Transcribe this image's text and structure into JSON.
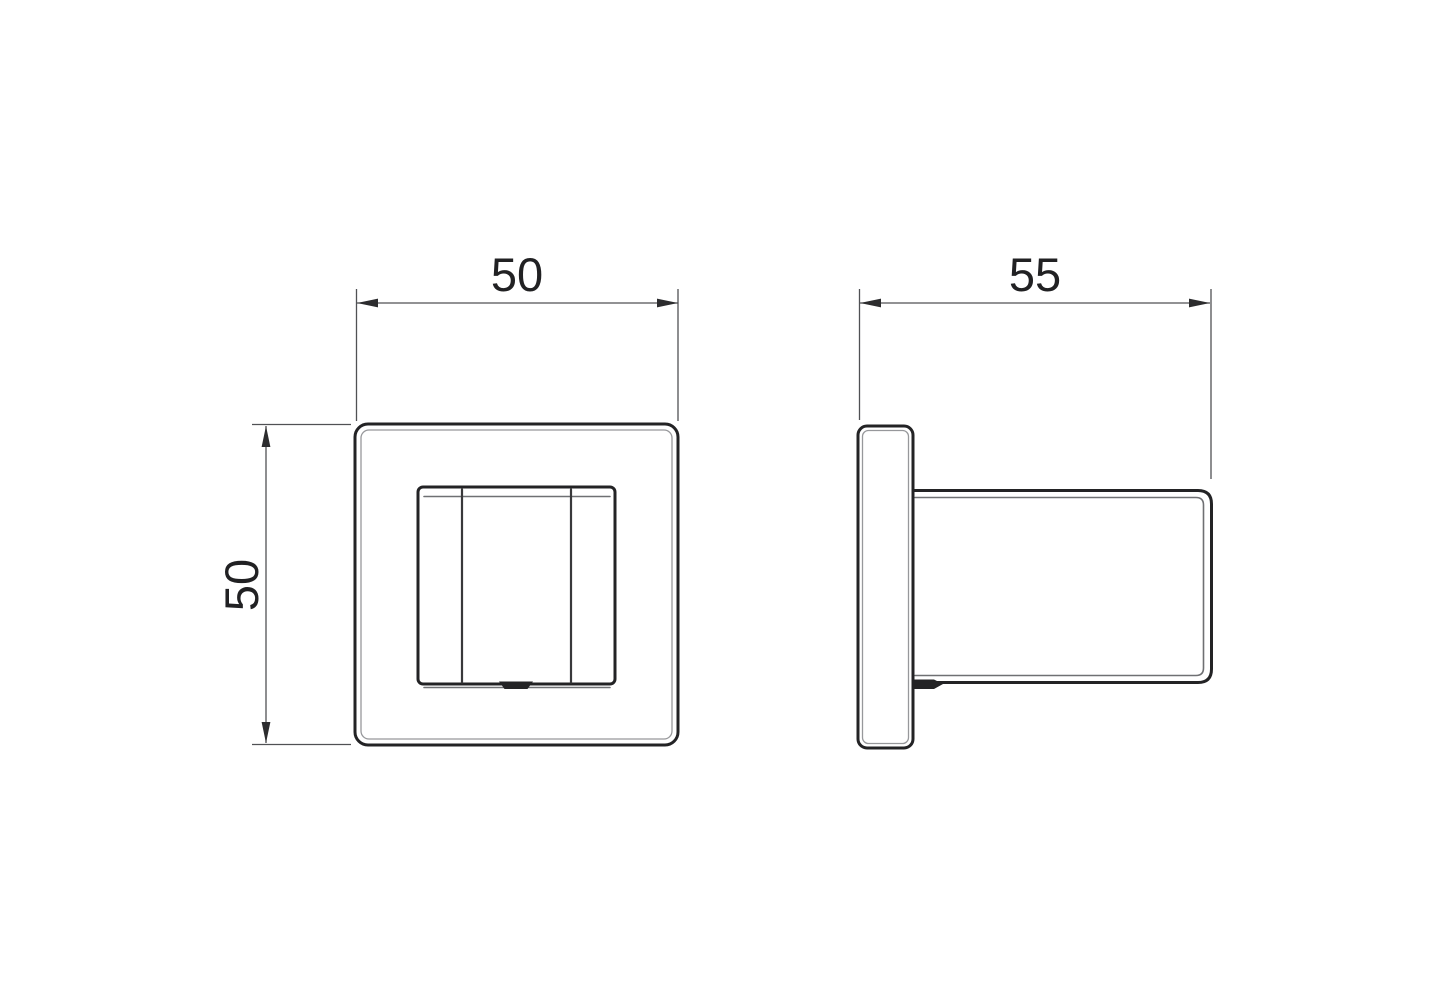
{
  "page": {
    "background": "#ffffff"
  },
  "drawing": {
    "type": "2-view orthographic technical drawing",
    "colors": {
      "object_line": "#232325",
      "chamfer_line": "#6f7073",
      "edge_highlight_line": "#97989b",
      "dimension_line": "#505154",
      "text": "#212123"
    },
    "dimensions": {
      "front_width": "50",
      "front_height": "50",
      "side_depth": "55"
    }
  }
}
